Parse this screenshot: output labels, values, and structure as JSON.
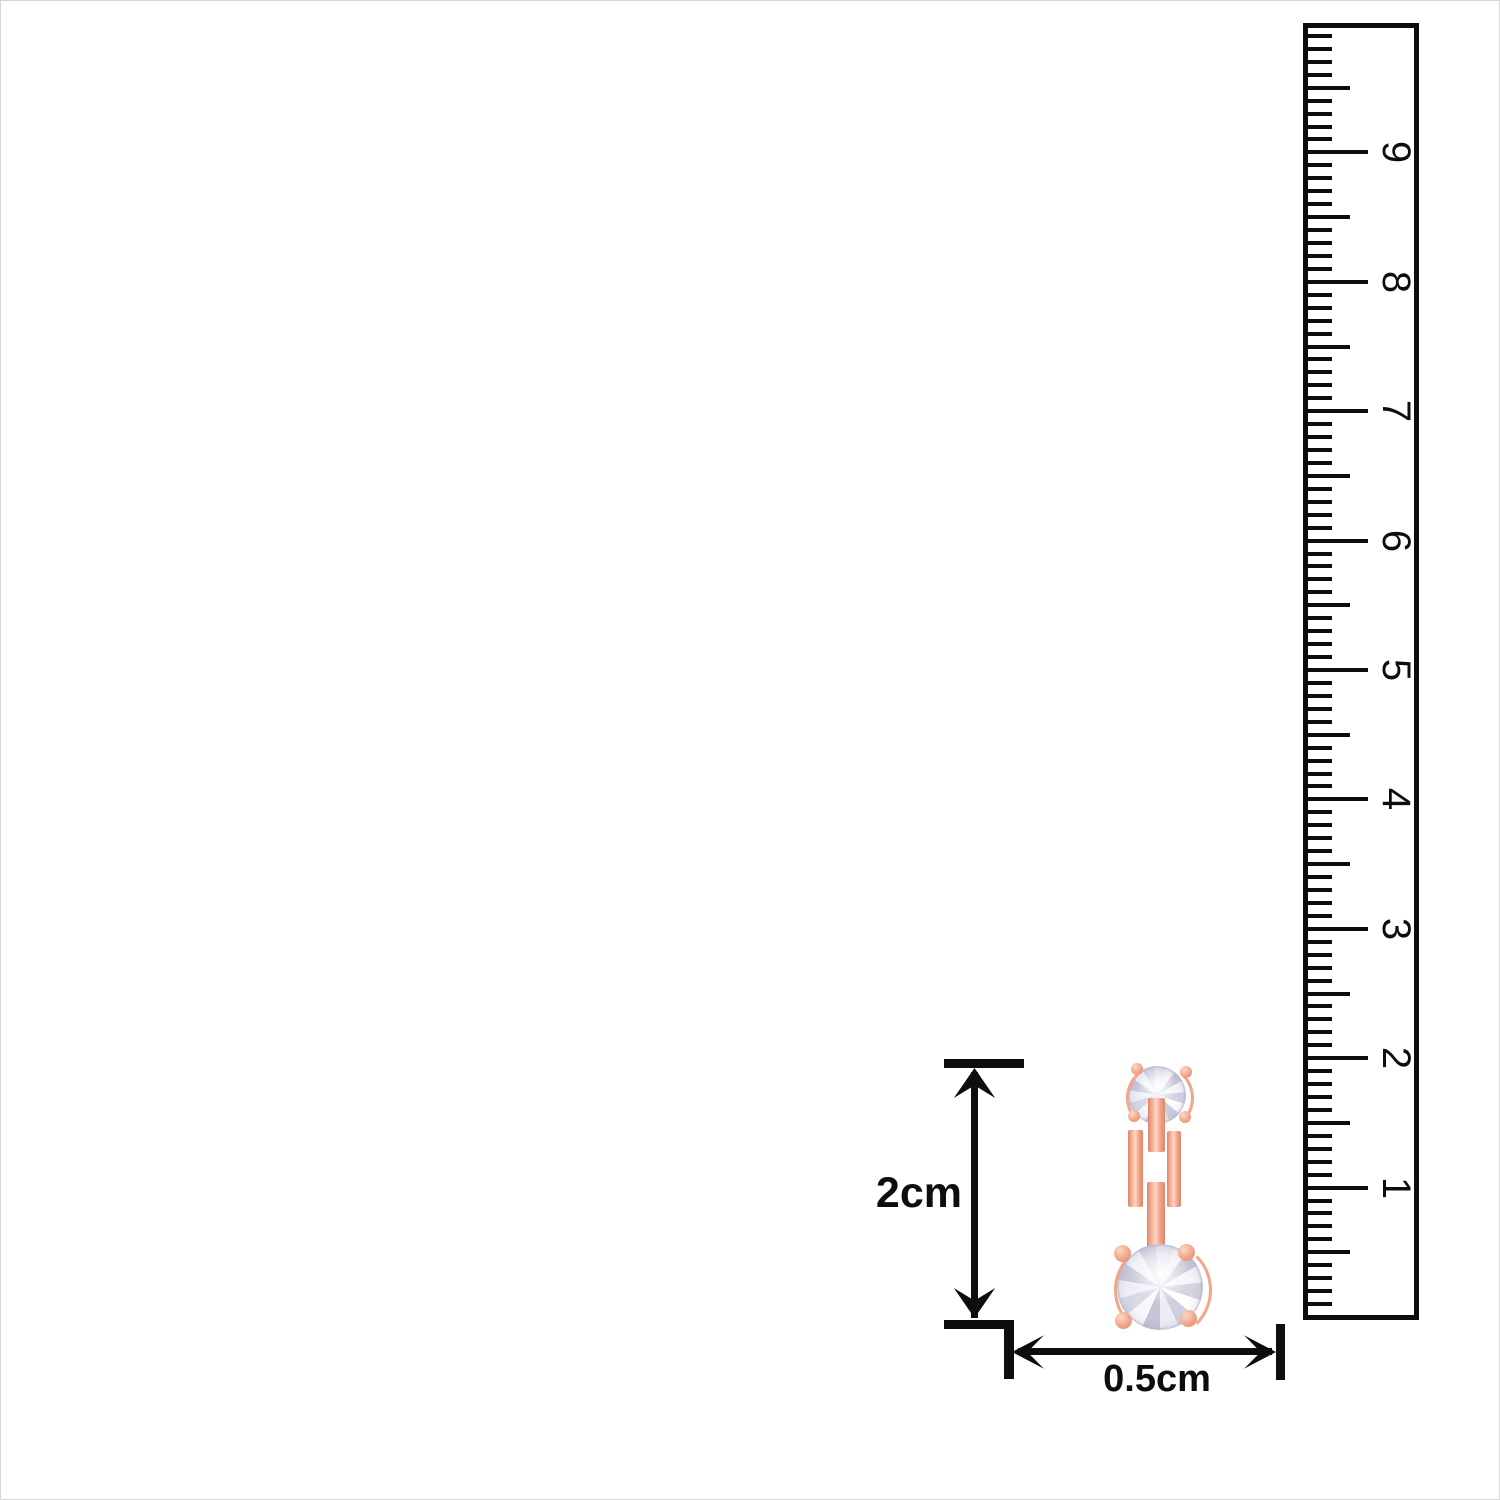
{
  "ruler": {
    "orientation": "vertical",
    "number_labels": [
      "9",
      "8",
      "7",
      "6",
      "5",
      "4",
      "3",
      "2",
      "1"
    ],
    "minor_ticks_per_cm": 10
  },
  "dimensions": {
    "height_label": "2cm",
    "width_label": "0.5cm"
  },
  "colors": {
    "background": "#ffffff",
    "ink": "#0d0d0d",
    "rose_gold": "#f2a58a",
    "rose_gold_light": "#fdd8c6",
    "rose_gold_dark": "#dd866b",
    "stone_light": "#f2f2f8",
    "stone_dark": "#c9c9d9"
  }
}
